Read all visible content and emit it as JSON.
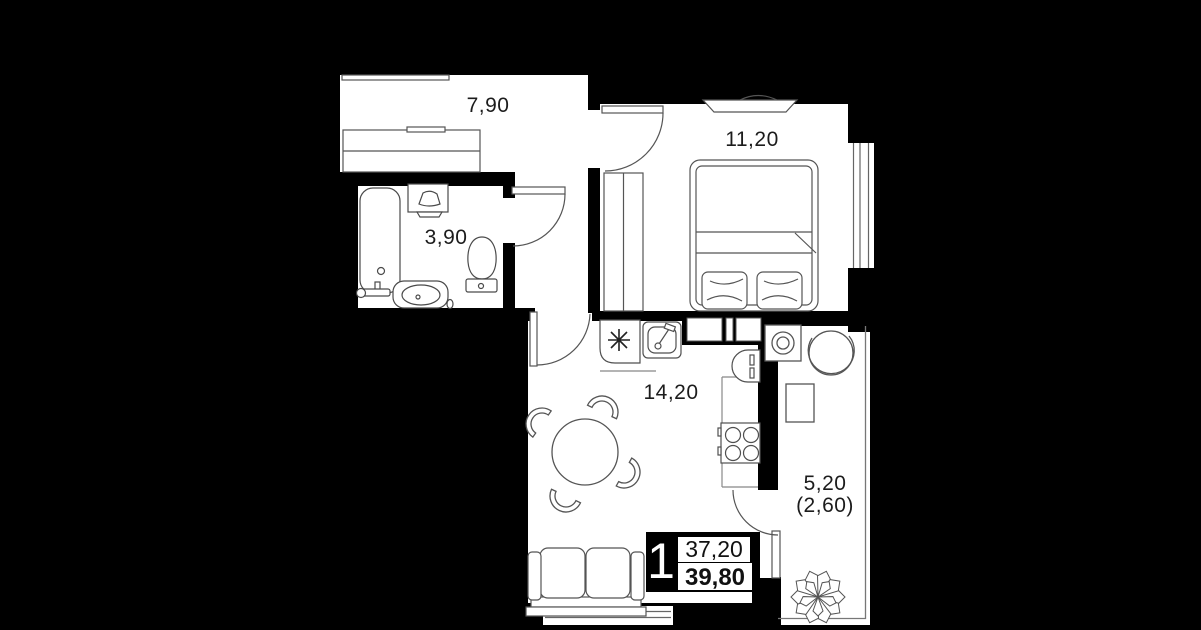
{
  "rooms": {
    "hallway": {
      "area": "7,90"
    },
    "bathroom": {
      "area": "3,90"
    },
    "bedroom": {
      "area": "11,20"
    },
    "kitchen_living": {
      "area": "14,20"
    },
    "balcony": {
      "area": "5,20",
      "area_with_coefficient": "(2,60)"
    }
  },
  "info_badge": {
    "room_count": "1",
    "living_area": "37,20",
    "total_area": "39,80"
  },
  "icons": [
    "bathtub-icon",
    "toilet-icon",
    "bathroom-sink-icon",
    "bath-cabinet-icon",
    "wardrobe-icon",
    "bed-icon",
    "pillow-icon",
    "tv-stand-icon",
    "fridge-icon",
    "kitchen-sink-icon",
    "stove-icon",
    "oven-icon",
    "dining-table-icon",
    "chair-icon",
    "sofa-icon",
    "washing-machine-icon",
    "armchair-icon",
    "balcony-table-icon",
    "plant-icon",
    "door-arc-icon",
    "window-icon"
  ],
  "colors": {
    "background": "#000000",
    "floor": "#ffffff",
    "furniture_line": "#4f4f4f",
    "text": "#1c1c1c",
    "badge_bg": "#000000",
    "badge_text": "#ffffff"
  }
}
